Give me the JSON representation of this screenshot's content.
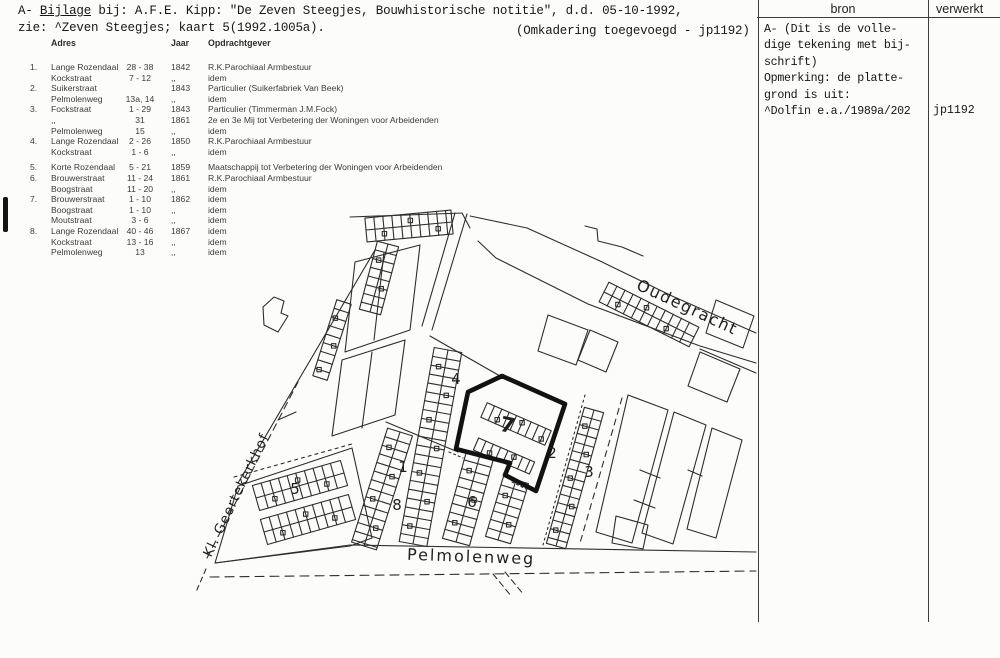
{
  "page": {
    "header_line1_prefix": "A- ",
    "header_line1_underlined": "Bijlage",
    "header_line1_rest": " bij: A.F.E. Kipp: \"De Zeven Steegjes, Bouwhistorische notitie\", d.d. 05-10-1992,",
    "header_line2": "zie: ^Zeven Steegjes; kaart 5(1992.1005a).",
    "header_note": "(Omkadering toegevoegd - jp1192)"
  },
  "table": {
    "headers": {
      "adres": "Adres",
      "jaar": "Jaar",
      "opdrachtgever": "Opdrachtgever"
    },
    "rows": [
      {
        "num": "1.",
        "street": "Lange Rozendaal",
        "range": "28 - 38",
        "year": "1842",
        "client": "R.K.Parochiaal Armbestuur"
      },
      {
        "num": "",
        "street": "Kockstraat",
        "range": "7 - 12",
        "year": ",,",
        "client": "idem"
      },
      {
        "num": "2.",
        "street": "Suikerstraat",
        "range": "",
        "year": "1843",
        "client": "Particulier (Suikerfabriek Van Beek)"
      },
      {
        "num": "",
        "street": "Pelmolenweg",
        "range": "13a, 14",
        "year": ",,",
        "client": "idem"
      },
      {
        "num": "3.",
        "street": "Fockstraat",
        "range": "1 - 29",
        "year": "1843",
        "client": "Particulier (Timmerman J.M.Fock)"
      },
      {
        "num": "",
        "street": ",,",
        "range": "31",
        "year": "1861",
        "client": "2e en 3e Mij tot Verbetering der Woningen voor Arbeidenden"
      },
      {
        "num": "",
        "street": "Pelmolenweg",
        "range": "15",
        "year": ",,",
        "client": "idem"
      },
      {
        "num": "4.",
        "street": "Lange Rozendaal",
        "range": "2 - 26",
        "year": "1850",
        "client": "R.K.Parochiaal Armbestuur"
      },
      {
        "num": "",
        "street": "Kockstraat",
        "range": "1 - 6",
        "year": ",,",
        "client": "idem"
      },
      {
        "num": "5.",
        "street": "Korte Rozendaal",
        "range": "5 - 21",
        "year": "1859",
        "client": "Maatschappij tot Verbetering der Woningen voor Arbeidenden"
      },
      {
        "num": "6.",
        "street": "Brouwerstraat",
        "range": "11 - 24",
        "year": "1861",
        "client": "R.K.Parochiaal Armbestuur"
      },
      {
        "num": "",
        "street": "Boogstraat",
        "range": "11 - 20",
        "year": ",,",
        "client": "idem"
      },
      {
        "num": "7.",
        "street": "Brouwerstraat",
        "range": "1 - 10",
        "year": "1862",
        "client": "idem"
      },
      {
        "num": "",
        "street": "Boogstraat",
        "range": "1 - 10",
        "year": ",,",
        "client": "idem"
      },
      {
        "num": "",
        "street": "Moutstraat",
        "range": "3 - 6",
        "year": ",,",
        "client": "idem"
      },
      {
        "num": "8.",
        "street": "Lange Rozendaal",
        "range": "40 - 46",
        "year": "1867",
        "client": "idem"
      },
      {
        "num": "",
        "street": "Kockstraat",
        "range": "13 - 16",
        "year": ",,",
        "client": "idem"
      },
      {
        "num": "",
        "street": "Pelmolenweg",
        "range": "13",
        "year": ",,",
        "client": "idem"
      }
    ]
  },
  "map": {
    "street_labels": [
      {
        "text": "Oudegracht",
        "x": 685,
        "y": 312,
        "rotate": 25,
        "size": 16,
        "spacing": 1.5
      },
      {
        "text": "Kl. Geertekerkhof",
        "x": 240,
        "y": 497,
        "rotate": -64.5,
        "size": 13.5,
        "spacing": 1
      },
      {
        "text": "Pelmolenweg",
        "x": 471,
        "y": 562,
        "rotate": 2,
        "size": 16,
        "spacing": 2
      }
    ],
    "area_numbers": [
      {
        "label": "1",
        "x": 403,
        "y": 472
      },
      {
        "label": "2",
        "x": 552,
        "y": 458
      },
      {
        "label": "3",
        "x": 589,
        "y": 477
      },
      {
        "label": "4",
        "x": 456,
        "y": 384
      },
      {
        "label": "5",
        "x": 295,
        "y": 494
      },
      {
        "label": "6",
        "x": 472,
        "y": 507
      },
      {
        "label": "7",
        "x": 506,
        "y": 432,
        "bold": true
      },
      {
        "label": "8",
        "x": 397,
        "y": 510
      }
    ]
  },
  "sidebar": {
    "col1_header": "bron",
    "col2_header": "verwerkt",
    "bron_lines": [
      "A- (Dit is de volle-",
      "dige tekening met bij-",
      "schrift)",
      "Opmerking: de platte-",
      "grond is uit:",
      "^Dolfin e.a./1989a/202"
    ],
    "verwerkt_value": "jp1192"
  }
}
